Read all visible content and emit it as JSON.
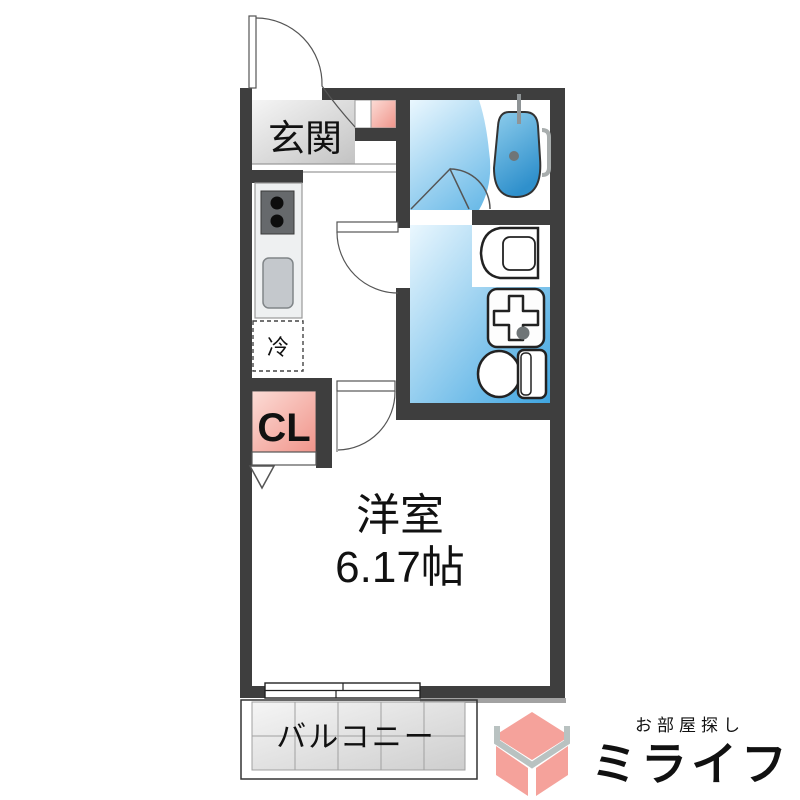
{
  "floorplan": {
    "rooms": {
      "genkan": {
        "label": "玄関"
      },
      "living": {
        "label": "洋室",
        "size": "6.17帖"
      },
      "balcony": {
        "label": "バルコニー"
      },
      "closet": {
        "label": "CL"
      },
      "fridge": {
        "label": "冷"
      }
    },
    "colors": {
      "wall": "#3e3e3e",
      "wet_floor_light": "#eaf7fe",
      "wet_floor_dark": "#3fa5e0",
      "genkan_light": "#f5f5f5",
      "genkan_dark": "#c3c3c3",
      "closet_light": "#fcdcd6",
      "closet_dark": "#f0948a",
      "tub_light": "#8ecdec",
      "tub_dark": "#2f90cc",
      "tile_light": "#f5f5f5",
      "tile_dark": "#cecece"
    }
  },
  "branding": {
    "tagline": "お部屋探し",
    "brand": "ミライフ",
    "brand_color": "#f2948c",
    "tagline_color": "#8b9191",
    "cube_pink": "#f5a29b",
    "cube_gray": "#b9c2c1"
  }
}
